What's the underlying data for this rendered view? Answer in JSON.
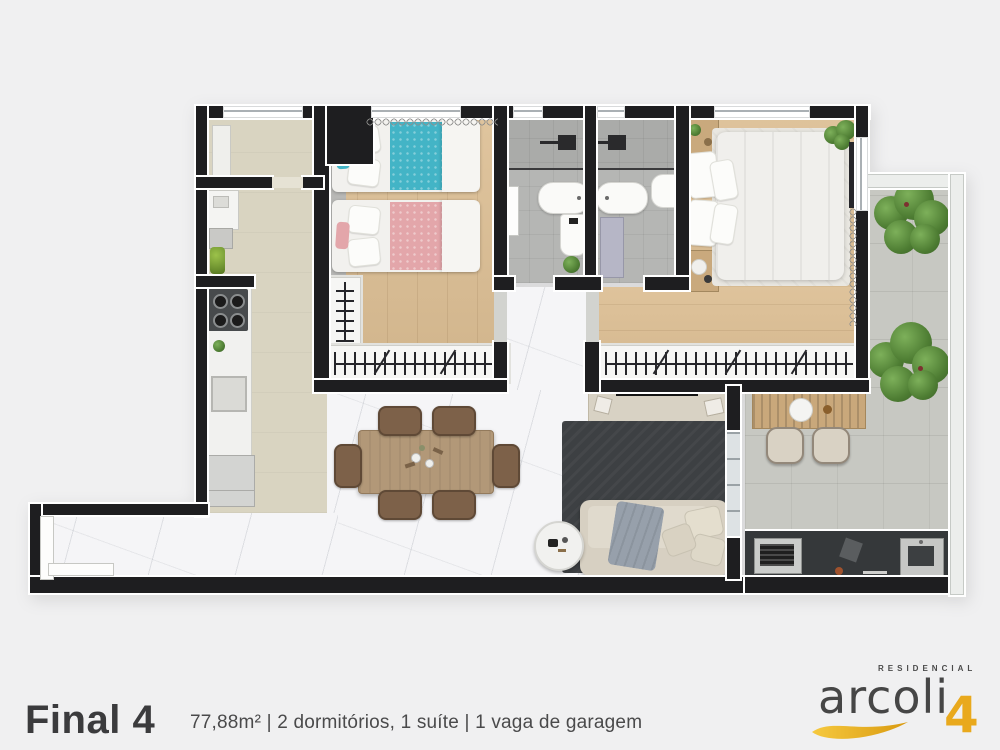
{
  "footer": {
    "unit_title": "Final 4",
    "specs": "77,88m² | 2 dormitórios, 1 suíte | 1 vaga de garagem"
  },
  "logo": {
    "tagline": "RESIDENCIAL",
    "brand": "arcoli",
    "unit_number": "4"
  },
  "palette": {
    "background": "#f0f0f1",
    "wall": "#1e1e20",
    "wood": "#dcbe93",
    "marble": "#f5f5f7",
    "beige": "#d9d4c1",
    "bath": "#b5b6b4",
    "concrete": "#c7c8c2",
    "accent_gold": "#e9a91d",
    "bed_blue": "#43b4c6",
    "bed_pink": "#e3a6aa",
    "rug_dark": "#3d4043",
    "counter_dark": "#35383a",
    "text_dark": "#3b3b3d"
  }
}
